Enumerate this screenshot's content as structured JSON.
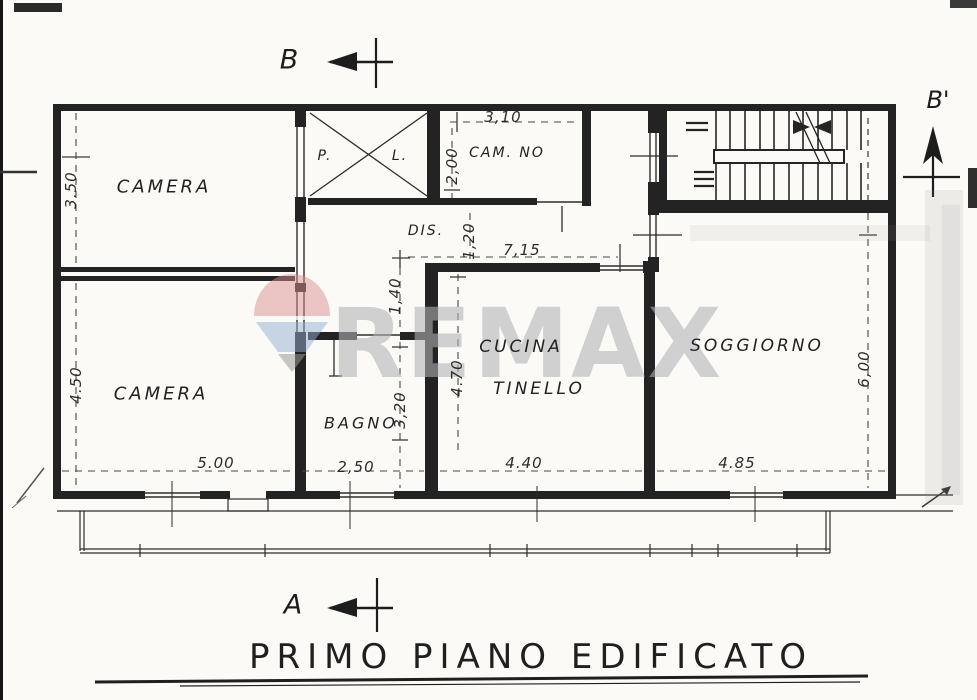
{
  "page": {
    "title_caption": "PRIMO PIANO EDIFICATO",
    "watermark": {
      "brand": "REMAX"
    },
    "section_markers": {
      "top": "B",
      "top_right": "B'",
      "bottom": "A"
    },
    "rooms": {
      "camera_top": "CAMERA",
      "camera_bottom": "CAMERA",
      "camerino": "CAM. NO",
      "disimpegno": "DIS.",
      "p_shaft": "P.",
      "l_shaft": "L.",
      "bagno": "BAGNO",
      "cucina": "CUCINA",
      "tinello": "TINELLO",
      "soggiorno": "SOGGIORNO"
    },
    "dimensions": {
      "d350": "3.50",
      "d450": "4.50",
      "d500": "5.00",
      "d250": "2,50",
      "d440": "4.40",
      "d485": "4.85",
      "d310": "3,10",
      "d200": "2,00",
      "d120": "1,20",
      "d715": "7,15",
      "d140": "1,40",
      "d470": "4.70",
      "d320": "3,20",
      "d600": "6,00"
    },
    "colors": {
      "ink": "#232323",
      "watermark_gray": "#b2b3b8",
      "balloon_red": "#d9908f",
      "balloon_blue": "#92aed0"
    }
  }
}
